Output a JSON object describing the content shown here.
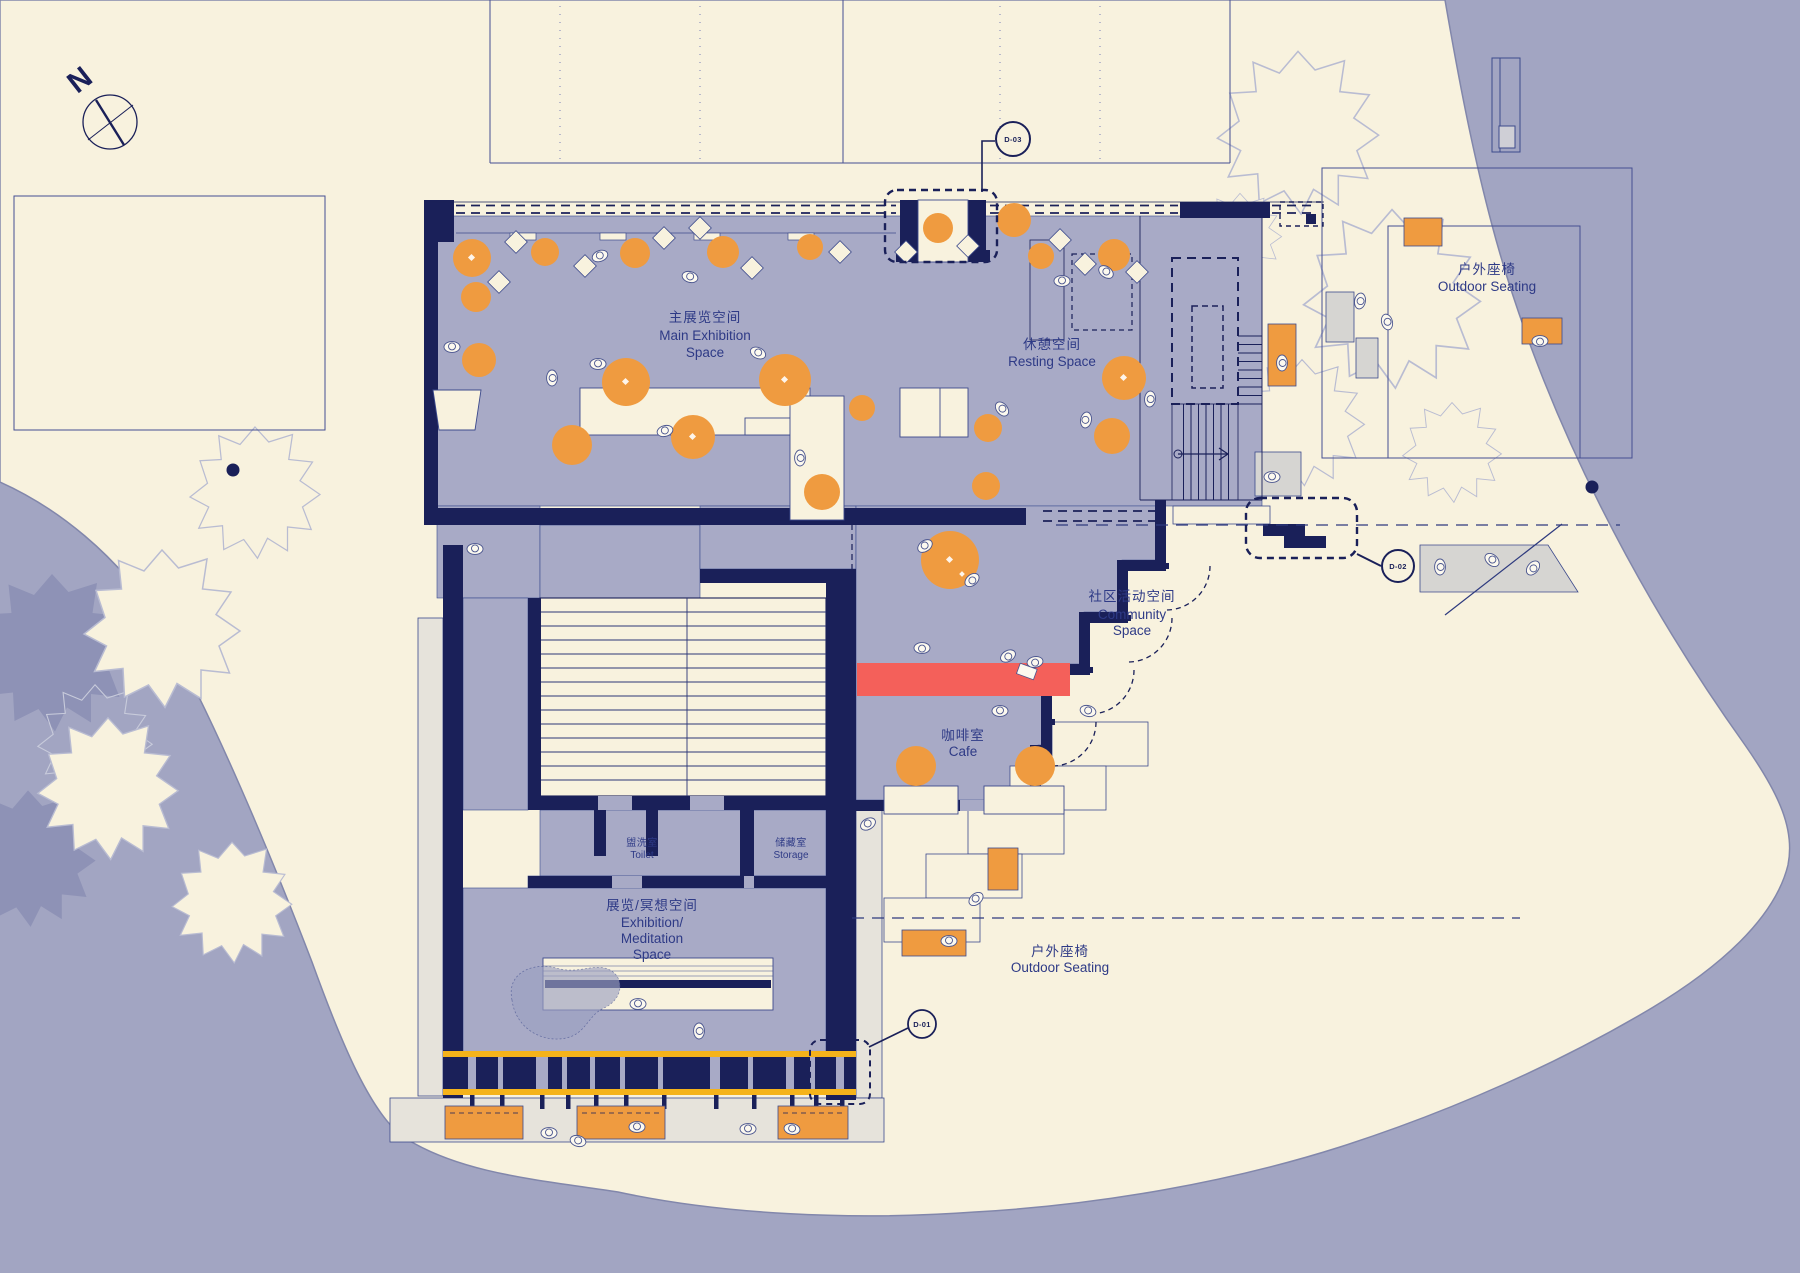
{
  "colors": {
    "paper": "#f8f2de",
    "water": "#a2a5c2",
    "floor": "#a8aac6",
    "wall": "#1a2059",
    "orange": "#ef9b40",
    "red": "#f4605a",
    "yellow": "#f5b31b",
    "terrace_gray": "#e6e3db",
    "bench_gray": "#d6d5d2",
    "label": "#2e3a86",
    "tree_outline": "#b9bcd2",
    "water_bush": "#8e92b6"
  },
  "compass": {
    "north_label": "N"
  },
  "rooms": {
    "main_exhibition": {
      "lines": [
        "主展览空间",
        "Main Exhibition",
        "Space"
      ]
    },
    "resting": {
      "lines": [
        "休憩空间",
        "Resting Space"
      ]
    },
    "community": {
      "lines": [
        "社区活动空间",
        "Community",
        "Space"
      ]
    },
    "cafe": {
      "lines": [
        "咖啡室",
        "Cafe"
      ]
    },
    "toilet": {
      "lines": [
        "盥洗室",
        "Toilet"
      ]
    },
    "storage": {
      "lines": [
        "储藏室",
        "Storage"
      ]
    },
    "exhibition_meditation": {
      "lines": [
        "展览/冥想空间",
        "Exhibition/",
        "Meditation",
        "Space"
      ]
    },
    "outdoor_seating_ne": {
      "lines": [
        "户外座椅",
        "Outdoor Seating"
      ]
    },
    "outdoor_seating_s": {
      "lines": [
        "户外座椅",
        "Outdoor Seating"
      ]
    }
  },
  "detail_markers": {
    "d01": "D-01",
    "d02": "D-02",
    "d03": "D-03"
  }
}
